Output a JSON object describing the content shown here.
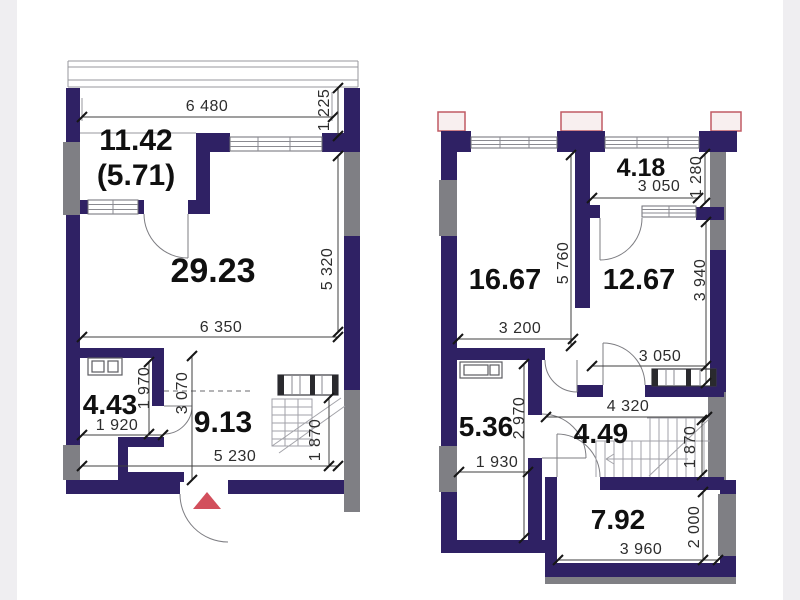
{
  "colors": {
    "page_bg": "#ffffff",
    "edge_band": "#efeef1",
    "wall_main": "#2f2164",
    "wall_secondary": "#7f7f84",
    "line": "#3f3f3f",
    "dim_text": "#2d2d2d",
    "room_text": "#101010",
    "entrance_marker": "#d24f5c",
    "exterior_unit_border": "#c05a64",
    "exterior_unit_fill": "#f8efef"
  },
  "floor1": {
    "rooms": {
      "balcony": {
        "area": "11.42",
        "area_reduced": "(5.71)"
      },
      "living": {
        "area": "29.23"
      },
      "bathroom": {
        "area": "4.43"
      },
      "hall": {
        "area": "9.13"
      }
    },
    "dims": {
      "top_width": "6 480",
      "balcony_depth": "1 225",
      "living_height": "5 320",
      "living_width": "6 350",
      "bathroom_height": "1 970",
      "bathroom_width": "1 920",
      "hall_height": "3 070",
      "hall_width": "5 230",
      "stairs_height": "1 870"
    }
  },
  "floor2": {
    "rooms": {
      "balcony": {
        "area": "4.18"
      },
      "bedroom_left": {
        "area": "16.67"
      },
      "bedroom_right": {
        "area": "12.67"
      },
      "bathroom": {
        "area": "5.36"
      },
      "hall": {
        "area": "4.49"
      },
      "room_bottom": {
        "area": "7.92"
      }
    },
    "dims": {
      "balcony_width": "3 050",
      "balcony_depth": "1 280",
      "bedroom_left_height": "5 760",
      "bedroom_right_height": "3 940",
      "bedroom_left_width": "3 200",
      "bedroom_right_width": "3 050",
      "bathroom_height": "2 970",
      "bathroom_width": "1 930",
      "hall_width": "4 320",
      "stairs_height": "1 870",
      "room_bottom_width": "3 960",
      "room_bottom_height": "2 000"
    }
  }
}
